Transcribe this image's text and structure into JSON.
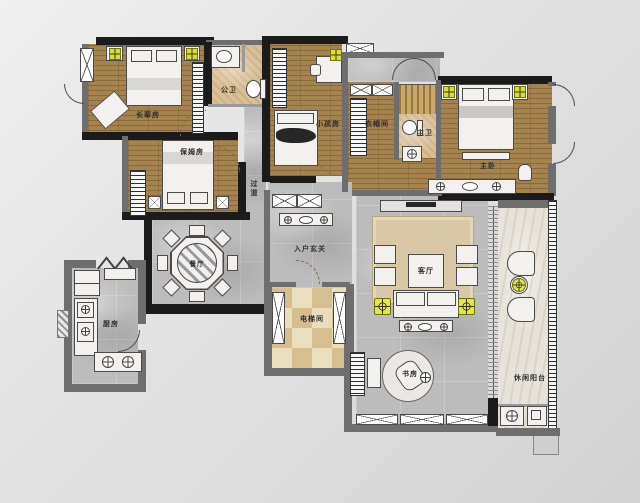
{
  "meta": {
    "type": "residential-floor-plan"
  },
  "rooms": {
    "elder_bedroom": {
      "label": "长辈房"
    },
    "nanny_room": {
      "label": "保姆房"
    },
    "public_bathroom": {
      "label": "公卫"
    },
    "kids_room": {
      "label": "小孩房"
    },
    "cloakroom": {
      "label": "衣帽间"
    },
    "master_bathroom": {
      "label": "主卫"
    },
    "master_bedroom": {
      "label": "主卧"
    },
    "corridor": {
      "label": "过道"
    },
    "dining_room": {
      "label": "餐厅"
    },
    "entry_foyer": {
      "label": "入户玄关"
    },
    "living_room": {
      "label": "客厅"
    },
    "kitchen": {
      "label": "厨房"
    },
    "elevator_hall": {
      "label": "电梯间"
    },
    "study": {
      "label": "书房"
    },
    "leisure_balcony": {
      "label": "休闲阳台"
    }
  },
  "colors": {
    "wood_floor": "#a5834e",
    "marble_floor": "#bcbcbc",
    "bath_floor": "#d8c096",
    "balcony_floor": "#e8e3da",
    "elevator_checker_light": "#eadfbd",
    "elevator_checker_dark": "#d6bf8f",
    "wall": "#1b1b1b",
    "accent_lamp": "#d6dd3c",
    "rug": "#d9c8a5"
  }
}
